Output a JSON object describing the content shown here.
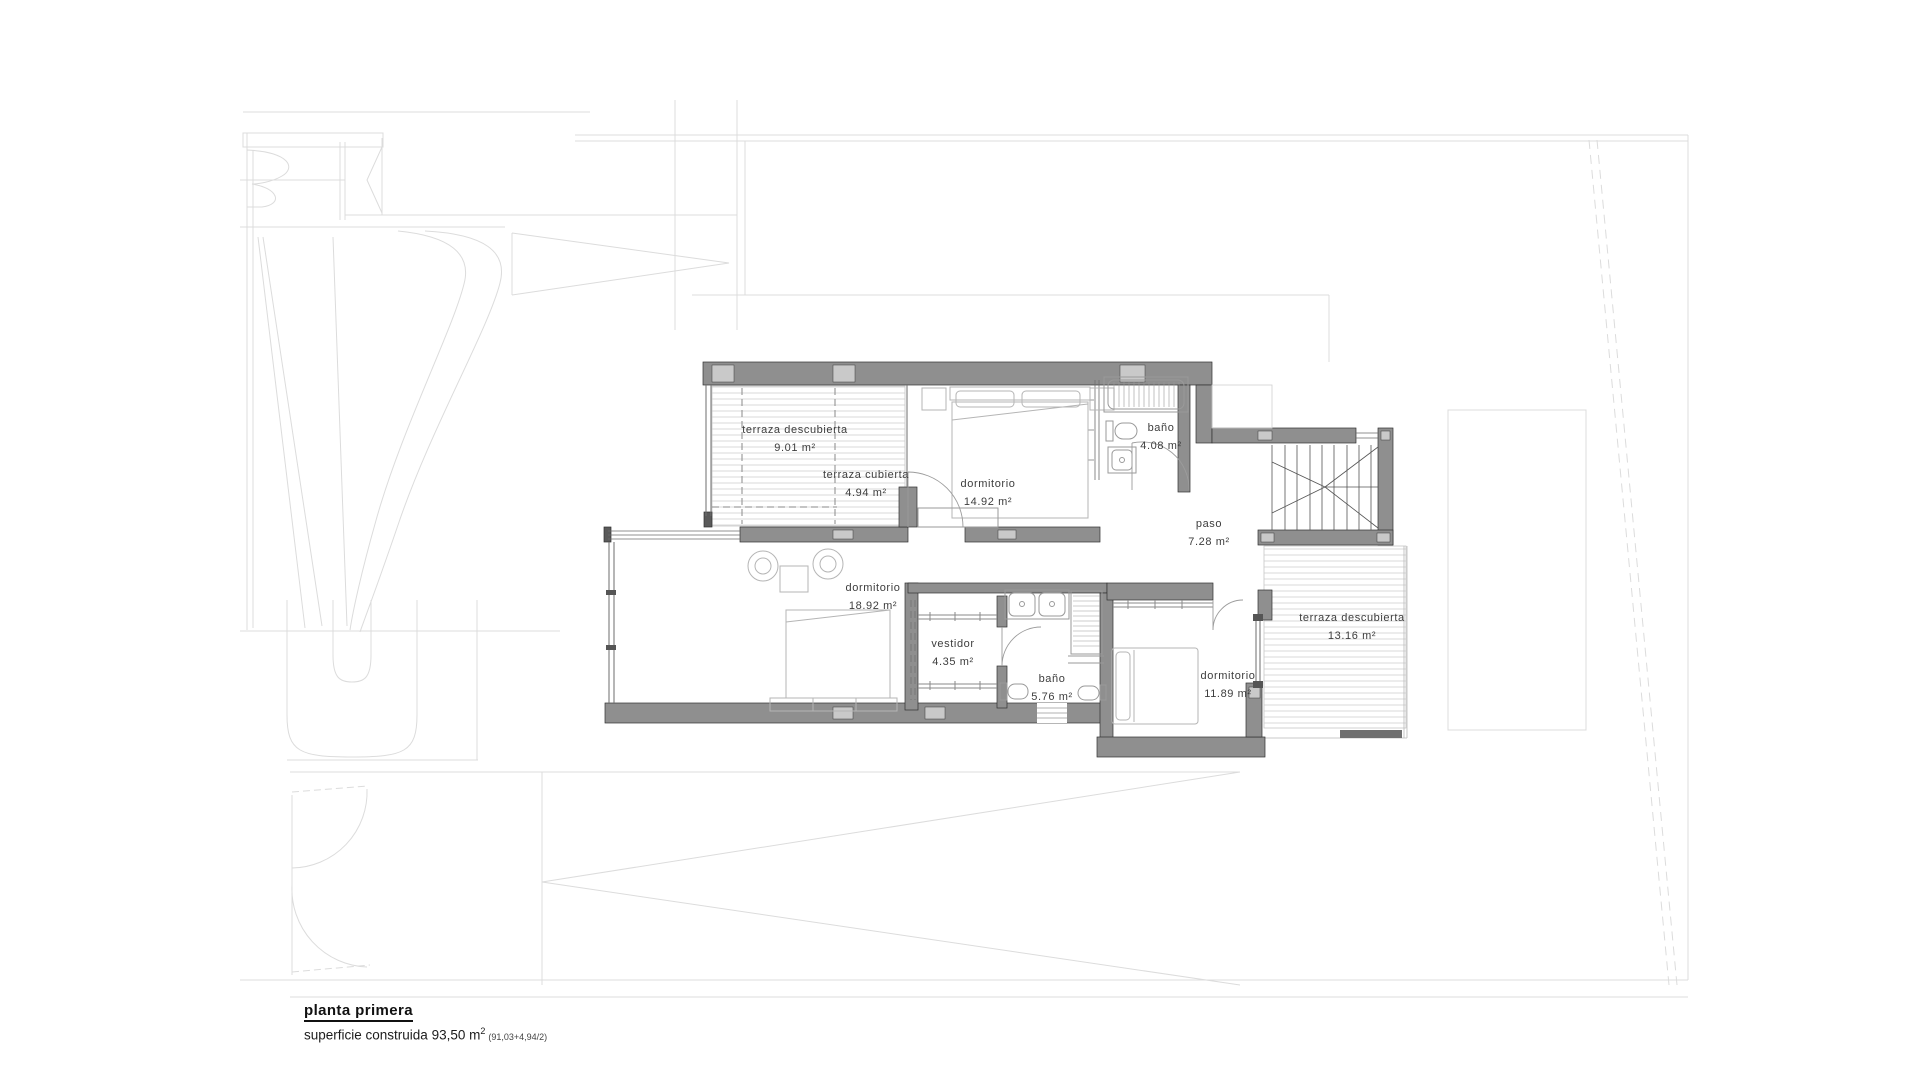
{
  "drawing": {
    "title": "planta primera",
    "surface_label": "superficie construida 93,50 m",
    "surface_sup": "2",
    "surface_note": "(91,03+4,94/2)"
  },
  "rooms": [
    {
      "name": "terraza descubierta",
      "area": "9.01 m²"
    },
    {
      "name": "terraza cubierta",
      "area": "4.94 m²"
    },
    {
      "name": "dormitorio",
      "area": "14.92 m²"
    },
    {
      "name": "baño",
      "area": "4.08 m²"
    },
    {
      "name": "paso",
      "area": "7.28 m²"
    },
    {
      "name": "dormitorio",
      "area": "18.92 m²"
    },
    {
      "name": "vestidor",
      "area": "4.35 m²"
    },
    {
      "name": "baño",
      "area": "5.76 m²"
    },
    {
      "name": "dormitorio",
      "area": "11.89 m²"
    },
    {
      "name": "terraza descubierta",
      "area": "13.16 m²"
    }
  ]
}
